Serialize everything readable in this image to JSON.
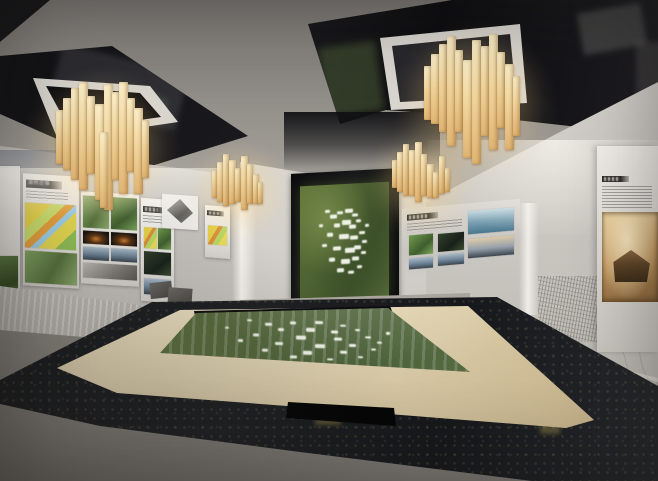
{
  "scene": {
    "type": "3d-interior-render",
    "subject": "urban planning exhibition hall with wooden slat chandeliers, exhibit wall panels, central aerial-map screen and glass-topped sand table",
    "panel_a_title": "湖熟古镇"
  },
  "palette": {
    "ceiling": "#8b8782",
    "ceiling_dark": "#141417",
    "frame_white": "#d8d5d0",
    "wood_light": "#faeec8",
    "wood_dark": "#e0b472",
    "wall_gray": "#c7c4bf",
    "panel_white": "#efede8",
    "title_bar": "#2b2a28",
    "map_green": "#4c6131",
    "map_speckle_white": "#f6f9ee",
    "table_beige": "#ecdfbe",
    "granite_black": "#1b1d20",
    "floor_gray": "#8f8b85",
    "mural_gray": "#c4c1bb",
    "niche_warm": "#c69a60"
  },
  "chandeliers": [
    {
      "x": 56,
      "y": 82,
      "glow": [
        -30,
        -10,
        150,
        150
      ],
      "bars": [
        [
          0,
          8,
          28,
          54
        ],
        [
          7,
          9,
          16,
          72
        ],
        [
          15,
          8,
          6,
          92
        ],
        [
          23,
          9,
          0,
          108
        ],
        [
          31,
          8,
          14,
          78
        ],
        [
          39,
          10,
          22,
          96
        ],
        [
          48,
          9,
          2,
          126
        ],
        [
          56,
          8,
          10,
          88
        ],
        [
          63,
          9,
          0,
          112
        ],
        [
          71,
          8,
          16,
          74
        ],
        [
          78,
          9,
          26,
          86
        ],
        [
          86,
          7,
          38,
          58
        ],
        [
          44,
          8,
          50,
          76
        ]
      ]
    },
    {
      "x": 212,
      "y": 152,
      "glow": [
        -20,
        -8,
        95,
        95
      ],
      "bars": [
        [
          0,
          6,
          18,
          28
        ],
        [
          5,
          7,
          10,
          40
        ],
        [
          11,
          6,
          2,
          52
        ],
        [
          17,
          7,
          8,
          44
        ],
        [
          23,
          6,
          16,
          34
        ],
        [
          29,
          7,
          4,
          54
        ],
        [
          35,
          6,
          12,
          40
        ],
        [
          41,
          6,
          22,
          30
        ],
        [
          46,
          5,
          30,
          22
        ]
      ]
    },
    {
      "x": 424,
      "y": 34,
      "glow": [
        -28,
        -8,
        155,
        155
      ],
      "bars": [
        [
          0,
          8,
          32,
          54
        ],
        [
          7,
          9,
          20,
          70
        ],
        [
          15,
          8,
          10,
          88
        ],
        [
          23,
          9,
          2,
          110
        ],
        [
          31,
          8,
          16,
          82
        ],
        [
          39,
          10,
          26,
          98
        ],
        [
          48,
          9,
          6,
          124
        ],
        [
          57,
          8,
          12,
          90
        ],
        [
          65,
          9,
          0,
          116
        ],
        [
          73,
          8,
          18,
          76
        ],
        [
          81,
          9,
          30,
          86
        ],
        [
          89,
          7,
          42,
          60
        ]
      ]
    },
    {
      "x": 392,
      "y": 140,
      "glow": [
        -20,
        -8,
        100,
        100
      ],
      "bars": [
        [
          0,
          6,
          20,
          28
        ],
        [
          5,
          7,
          12,
          40
        ],
        [
          11,
          6,
          4,
          52
        ],
        [
          17,
          7,
          10,
          46
        ],
        [
          23,
          7,
          2,
          60
        ],
        [
          29,
          6,
          14,
          42
        ],
        [
          35,
          7,
          24,
          34
        ],
        [
          41,
          6,
          32,
          26
        ],
        [
          47,
          6,
          16,
          38
        ],
        [
          53,
          5,
          28,
          24
        ]
      ]
    }
  ],
  "map_speckles": [
    [
      28,
      22,
      5,
      3
    ],
    [
      34,
      26,
      7,
      4
    ],
    [
      42,
      24,
      6,
      3
    ],
    [
      50,
      22,
      8,
      4
    ],
    [
      58,
      26,
      6,
      3
    ],
    [
      47,
      32,
      9,
      5
    ],
    [
      38,
      34,
      6,
      4
    ],
    [
      55,
      36,
      7,
      4
    ],
    [
      63,
      32,
      5,
      3
    ],
    [
      30,
      42,
      6,
      4
    ],
    [
      44,
      44,
      10,
      5
    ],
    [
      56,
      46,
      8,
      4
    ],
    [
      66,
      42,
      6,
      3
    ],
    [
      25,
      52,
      5,
      3
    ],
    [
      37,
      54,
      8,
      4
    ],
    [
      50,
      56,
      10,
      5
    ],
    [
      61,
      54,
      7,
      4
    ],
    [
      70,
      50,
      5,
      3
    ],
    [
      33,
      64,
      6,
      4
    ],
    [
      46,
      66,
      9,
      5
    ],
    [
      58,
      64,
      7,
      4
    ],
    [
      68,
      60,
      5,
      3
    ],
    [
      42,
      74,
      7,
      4
    ],
    [
      54,
      76,
      6,
      3
    ],
    [
      64,
      72,
      5,
      3
    ],
    [
      21,
      34,
      4,
      3
    ],
    [
      73,
      36,
      4,
      3
    ]
  ]
}
